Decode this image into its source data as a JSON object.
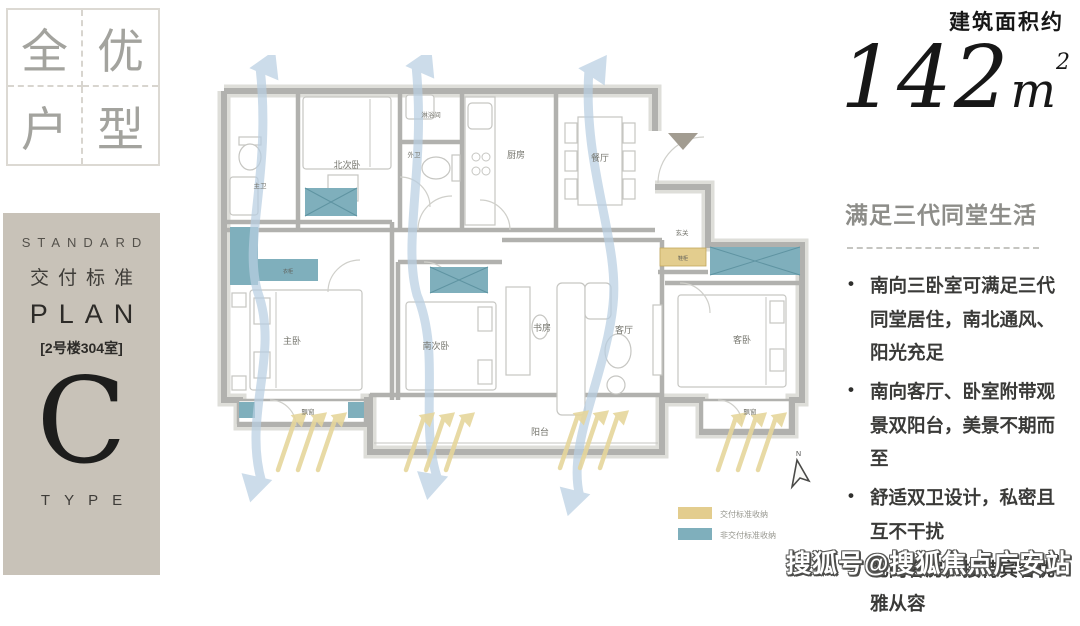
{
  "badge": {
    "chars": [
      "全",
      "优",
      "户",
      "型"
    ]
  },
  "standard_card": {
    "eyebrow": "STANDARD",
    "subtitle": "交付标准",
    "title": "PLAN",
    "unit_label": "[2号楼304室]",
    "letter": "C",
    "footer": "TYPE"
  },
  "area": {
    "label": "建筑面积约",
    "value": "142",
    "unit": "m",
    "sup": "2"
  },
  "selling_points": {
    "title": "满足三代同堂生活",
    "bullets": [
      "南向三卧室可满足三代同堂居住，南北通风、阳光充足",
      "南向客厅、卧室附带观景双阳台，美景不期而至",
      "舒适双卫设计，私密且互不干扰",
      "北向客房，接待宾客优雅从容"
    ]
  },
  "plan": {
    "rooms": {
      "master_bath": "主卫",
      "north_bedroom": "北次卧",
      "shower_room": "淋浴间",
      "guest_bath": "外卫",
      "kitchen": "厨房",
      "dining": "餐厅",
      "foyer": "玄关",
      "master_bedroom": "主卧",
      "south_bedroom": "南次卧",
      "study": "书房",
      "living": "客厅",
      "guest_bedroom": "客卧",
      "balcony": "阳台",
      "bay_window_left": "飘窗",
      "bay_window_right": "飘窗",
      "wardrobe": "衣柜",
      "shoe_cabinet": "鞋柜"
    },
    "legend": [
      {
        "label": "交付标准收纳",
        "color": "#e3cd8e"
      },
      {
        "label": "非交付标准收纳",
        "color": "#7fafbc"
      }
    ],
    "north": "N",
    "colors": {
      "wall": "#b1b1ae",
      "standard_storage": "#e3cd8e",
      "nonstandard_storage": "#7fafbc",
      "airflow": "#b9cfe2",
      "sunlight": "#e6d69c"
    }
  },
  "watermark": "搜狐号@搜狐焦点广安站"
}
